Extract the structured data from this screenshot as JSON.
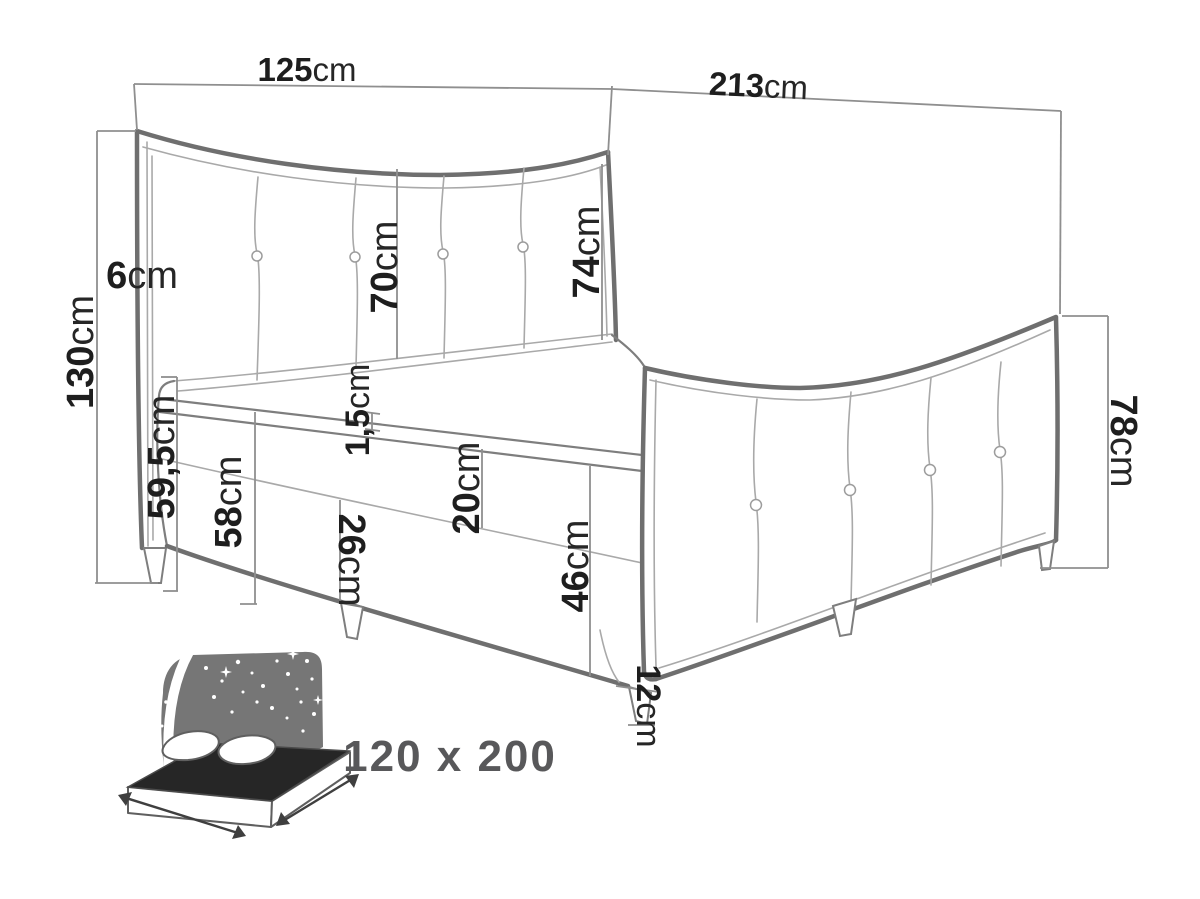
{
  "title": "Boxspring bed dimensions diagram",
  "dimensions": {
    "headboard_width": {
      "value": "125",
      "unit": "cm"
    },
    "bed_length": {
      "value": "213",
      "unit": "cm"
    },
    "headboard_height": {
      "value": "130",
      "unit": "cm"
    },
    "headboard_frame": {
      "value": "6",
      "unit": "cm"
    },
    "headboard_panel_mid": {
      "value": "70",
      "unit": "cm"
    },
    "headboard_panel_side": {
      "value": "74",
      "unit": "cm"
    },
    "topper_seam": {
      "value": "1,5",
      "unit": "cm"
    },
    "floor_to_sleep_surface": {
      "value": "59,5",
      "unit": "cm"
    },
    "floor_to_topper_base": {
      "value": "58",
      "unit": "cm"
    },
    "upper_box_section": {
      "value": "20",
      "unit": "cm"
    },
    "lower_box_section": {
      "value": "26",
      "unit": "cm"
    },
    "box_height": {
      "value": "46",
      "unit": "cm"
    },
    "footboard_height": {
      "value": "78",
      "unit": "cm"
    },
    "leg_height": {
      "value": "12",
      "unit": "cm"
    }
  },
  "badge": {
    "size_label": "120 x 200"
  },
  "colors": {
    "background": "#ffffff",
    "outline_thick": "#6f6f6f",
    "outline_thin": "#a9a9a9",
    "dimension_line": "#8f8f8f",
    "label_text": "#1e1e1e",
    "badge_text": "#58585a",
    "icon_fill": "#767676"
  }
}
